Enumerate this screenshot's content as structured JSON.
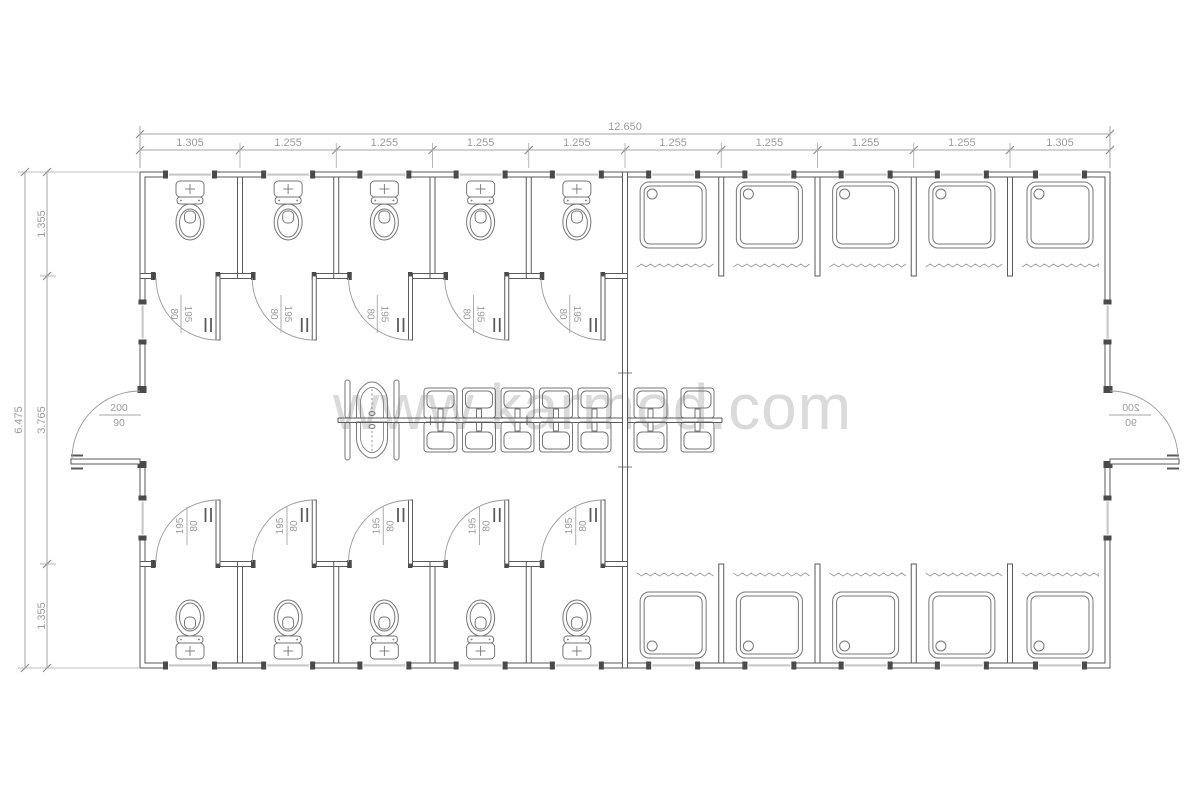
{
  "watermark": {
    "text": "www.karmod.com"
  },
  "dimensions": {
    "overall_width": "12.650",
    "top_segments": [
      "1.305",
      "1.255",
      "1.255",
      "1.255",
      "1.255",
      "1.255",
      "1.255",
      "1.255",
      "1.255",
      "1.305"
    ],
    "overall_height": "6.475",
    "left_segments": [
      "1.355",
      "3.765",
      "1.355"
    ]
  },
  "labels": {
    "external_door": {
      "num": "200",
      "den": "90"
    },
    "stall_door": {
      "num": "195",
      "den": "80"
    }
  },
  "fixtures": {
    "toilet_stalls_top": 5,
    "toilet_stalls_bottom": 5,
    "shower_stalls_top": 5,
    "shower_stalls_bottom": 5,
    "sinks_left_per_row": 5,
    "sinks_right_per_row": 2,
    "urinals": 2,
    "external_doors": 2
  },
  "colors": {
    "background": "#ffffff",
    "line": "#5a5a5a",
    "fixture": "#767676",
    "arc": "#9a9a9a",
    "dim_line": "#a6a6a6",
    "dim_text": "#9c9c9c",
    "tick": "#8f8f8f",
    "glazing": "#c9c9c9",
    "jamb": "#4a4a4a",
    "watermark": "#dadada"
  }
}
